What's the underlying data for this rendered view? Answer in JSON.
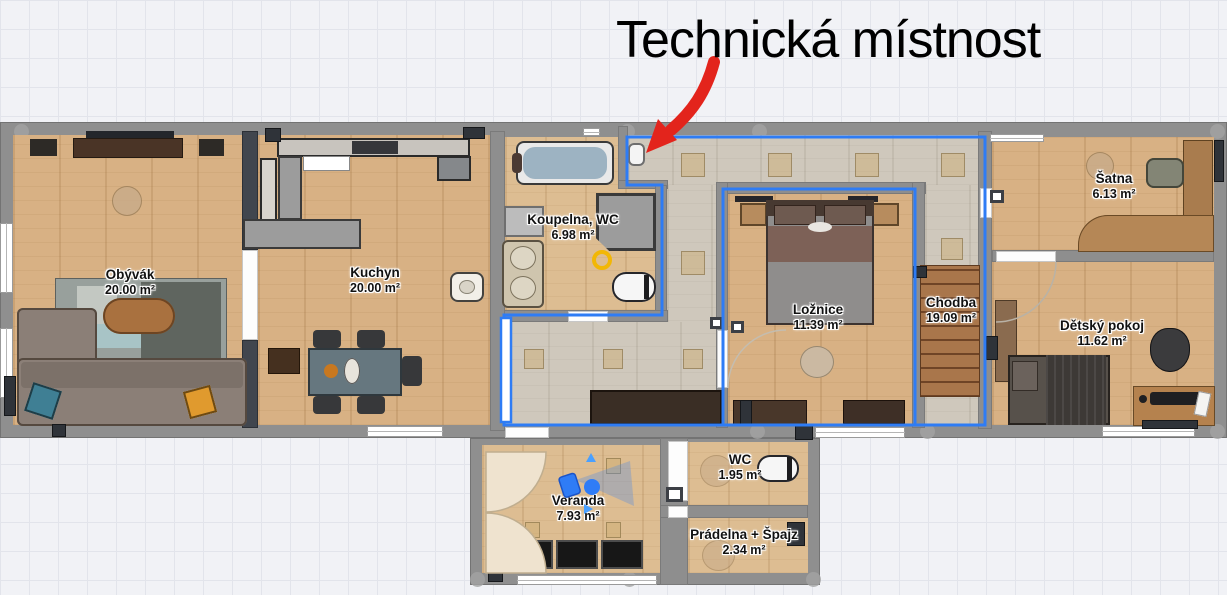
{
  "annotation": {
    "title": "Technická místnost",
    "arrow_color": "#e3241c"
  },
  "rooms": {
    "obyvak": {
      "name": "Obývák",
      "area": "20.00 m²"
    },
    "kuchyn": {
      "name": "Kuchyn",
      "area": "20.00 m²"
    },
    "koupelna": {
      "name": "Koupelna, WC",
      "area": "6.98 m²"
    },
    "loznice": {
      "name": "Ložnice",
      "area": "11.39 m²"
    },
    "chodba": {
      "name": "Chodba",
      "area": "19.09 m²"
    },
    "satna": {
      "name": "Šatna",
      "area": "6.13 m²"
    },
    "detsky": {
      "name": "Dětský pokoj",
      "area": "11.62 m²"
    },
    "veranda": {
      "name": "Veranda",
      "area": "7.93 m²"
    },
    "wc": {
      "name": "WC",
      "area": "1.95 m²"
    },
    "pradelna": {
      "name": "Prádelna + Špajz",
      "area": "2.34 m²"
    }
  },
  "colors": {
    "selection_blue": "#2e7cf5",
    "highlight_yellow": "#f2b705",
    "wall_gray": "#8e8e8e",
    "arrow_red": "#e3241c"
  }
}
